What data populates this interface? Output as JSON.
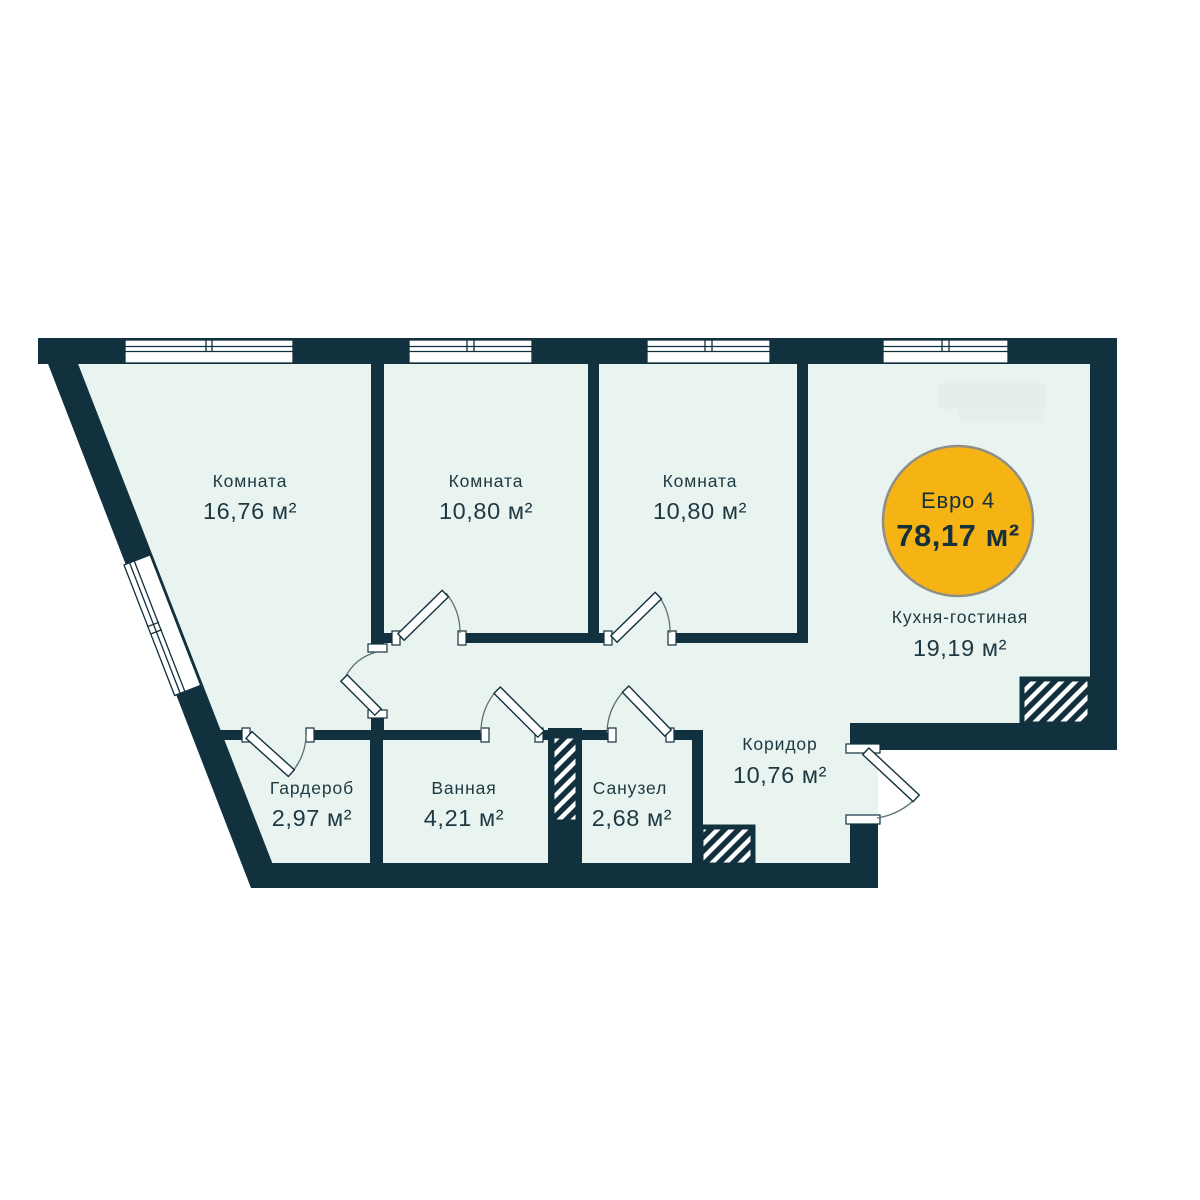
{
  "plan": {
    "badge": {
      "plan_type": "Евро 4",
      "total_area": "78,17 м²"
    },
    "rooms": [
      {
        "name": "Комната",
        "area": "16,76 м²"
      },
      {
        "name": "Комната",
        "area": "10,80 м²"
      },
      {
        "name": "Комната",
        "area": "10,80 м²"
      },
      {
        "name": "Кухня-гостиная",
        "area": "19,19 м²"
      },
      {
        "name": "Коридор",
        "area": "10,76 м²"
      },
      {
        "name": "Гардероб",
        "area": "2,97 м²"
      },
      {
        "name": "Ванная",
        "area": "4,21 м²"
      },
      {
        "name": "Санузел",
        "area": "2,68 м²"
      }
    ],
    "colors": {
      "wall": "#12313E",
      "floor": "#E9F3EF",
      "badge_fill": "#F6B414",
      "badge_ring": "#8F8F88"
    }
  }
}
